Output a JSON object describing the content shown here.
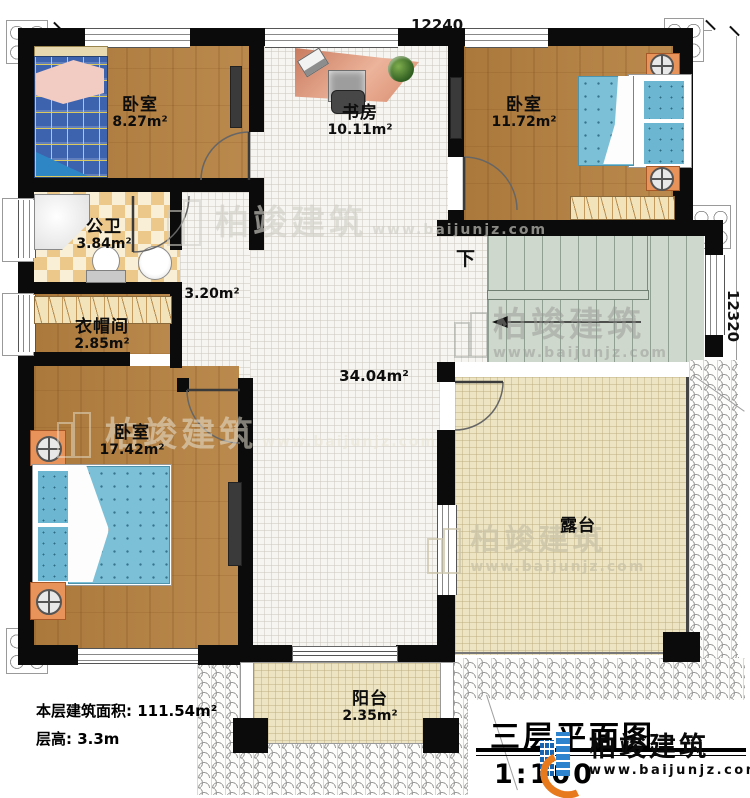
{
  "dimensions": {
    "top": "12240",
    "right": "12320"
  },
  "rooms": {
    "bedroom_top_left": {
      "name": "卧室",
      "area": "8.27m²"
    },
    "study": {
      "name": "书房",
      "area": "10.11m²"
    },
    "bedroom_top_right": {
      "name": "卧室",
      "area": "11.72m²"
    },
    "bathroom": {
      "name": "公卫",
      "area": "3.84m²"
    },
    "corridor": {
      "area": "3.20m²"
    },
    "cloakroom": {
      "name": "衣帽间",
      "area": "2.85m²"
    },
    "bedroom_bottom_left": {
      "name": "卧室",
      "area": "17.42m²"
    },
    "hall": {
      "area": "34.04m²"
    },
    "terrace": {
      "name": "露台"
    },
    "balcony": {
      "name": "阳台",
      "area": "2.35m²"
    }
  },
  "stairs": {
    "down_label": "下"
  },
  "info": {
    "floor_area_label": "本层建筑面积:",
    "floor_area_value": "111.54m²",
    "floor_height_label": "层高:",
    "floor_height_value": "3.3m"
  },
  "title": {
    "text": "三层平面图",
    "scale": "1:100"
  },
  "brand": {
    "name": "柏竣建筑",
    "url": "www.baijunjz.com"
  },
  "watermark": {
    "name": "柏竣建筑",
    "url": "www.baijunjz.com"
  },
  "colors": {
    "wall": "#0b0b0b",
    "wood": "#b5803f",
    "bed_blue": "#7cc0d8",
    "plaid_blue": "#3e63ae",
    "stair_green": "#cfd8cc",
    "floor_cream": "#ece4c2",
    "accent_orange": "#e8935a",
    "brand_blue": "#1864b0",
    "brand_orange": "#e87a1e"
  }
}
